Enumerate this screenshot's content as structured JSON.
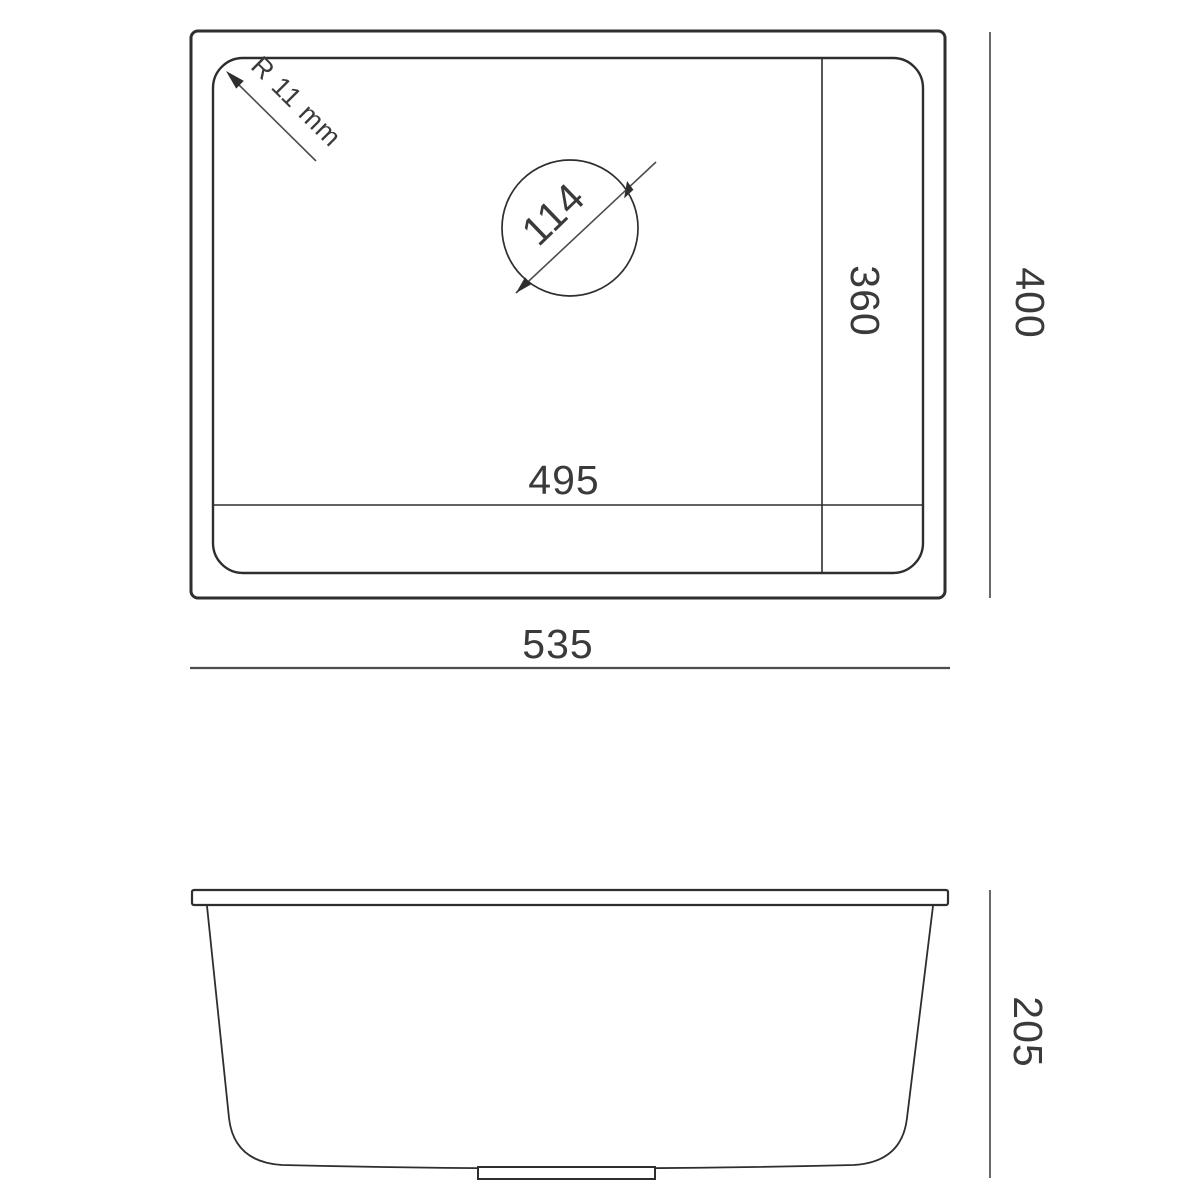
{
  "drawing": {
    "type": "technical-drawing",
    "subject": "undermount kitchen sink dimensional diagram",
    "top_view": {
      "corner_radius_label": "R 11 mm",
      "drain_hole_diameter": "114",
      "bowl_length": "495",
      "bowl_width": "360",
      "overall_length": "535",
      "overall_width": "400"
    },
    "side_view": {
      "height": "205"
    },
    "colors": {
      "outline": "#2e2e2e",
      "dimension_line": "#4d4d4d",
      "text": "#3a3a3a",
      "background": "#ffffff"
    }
  }
}
